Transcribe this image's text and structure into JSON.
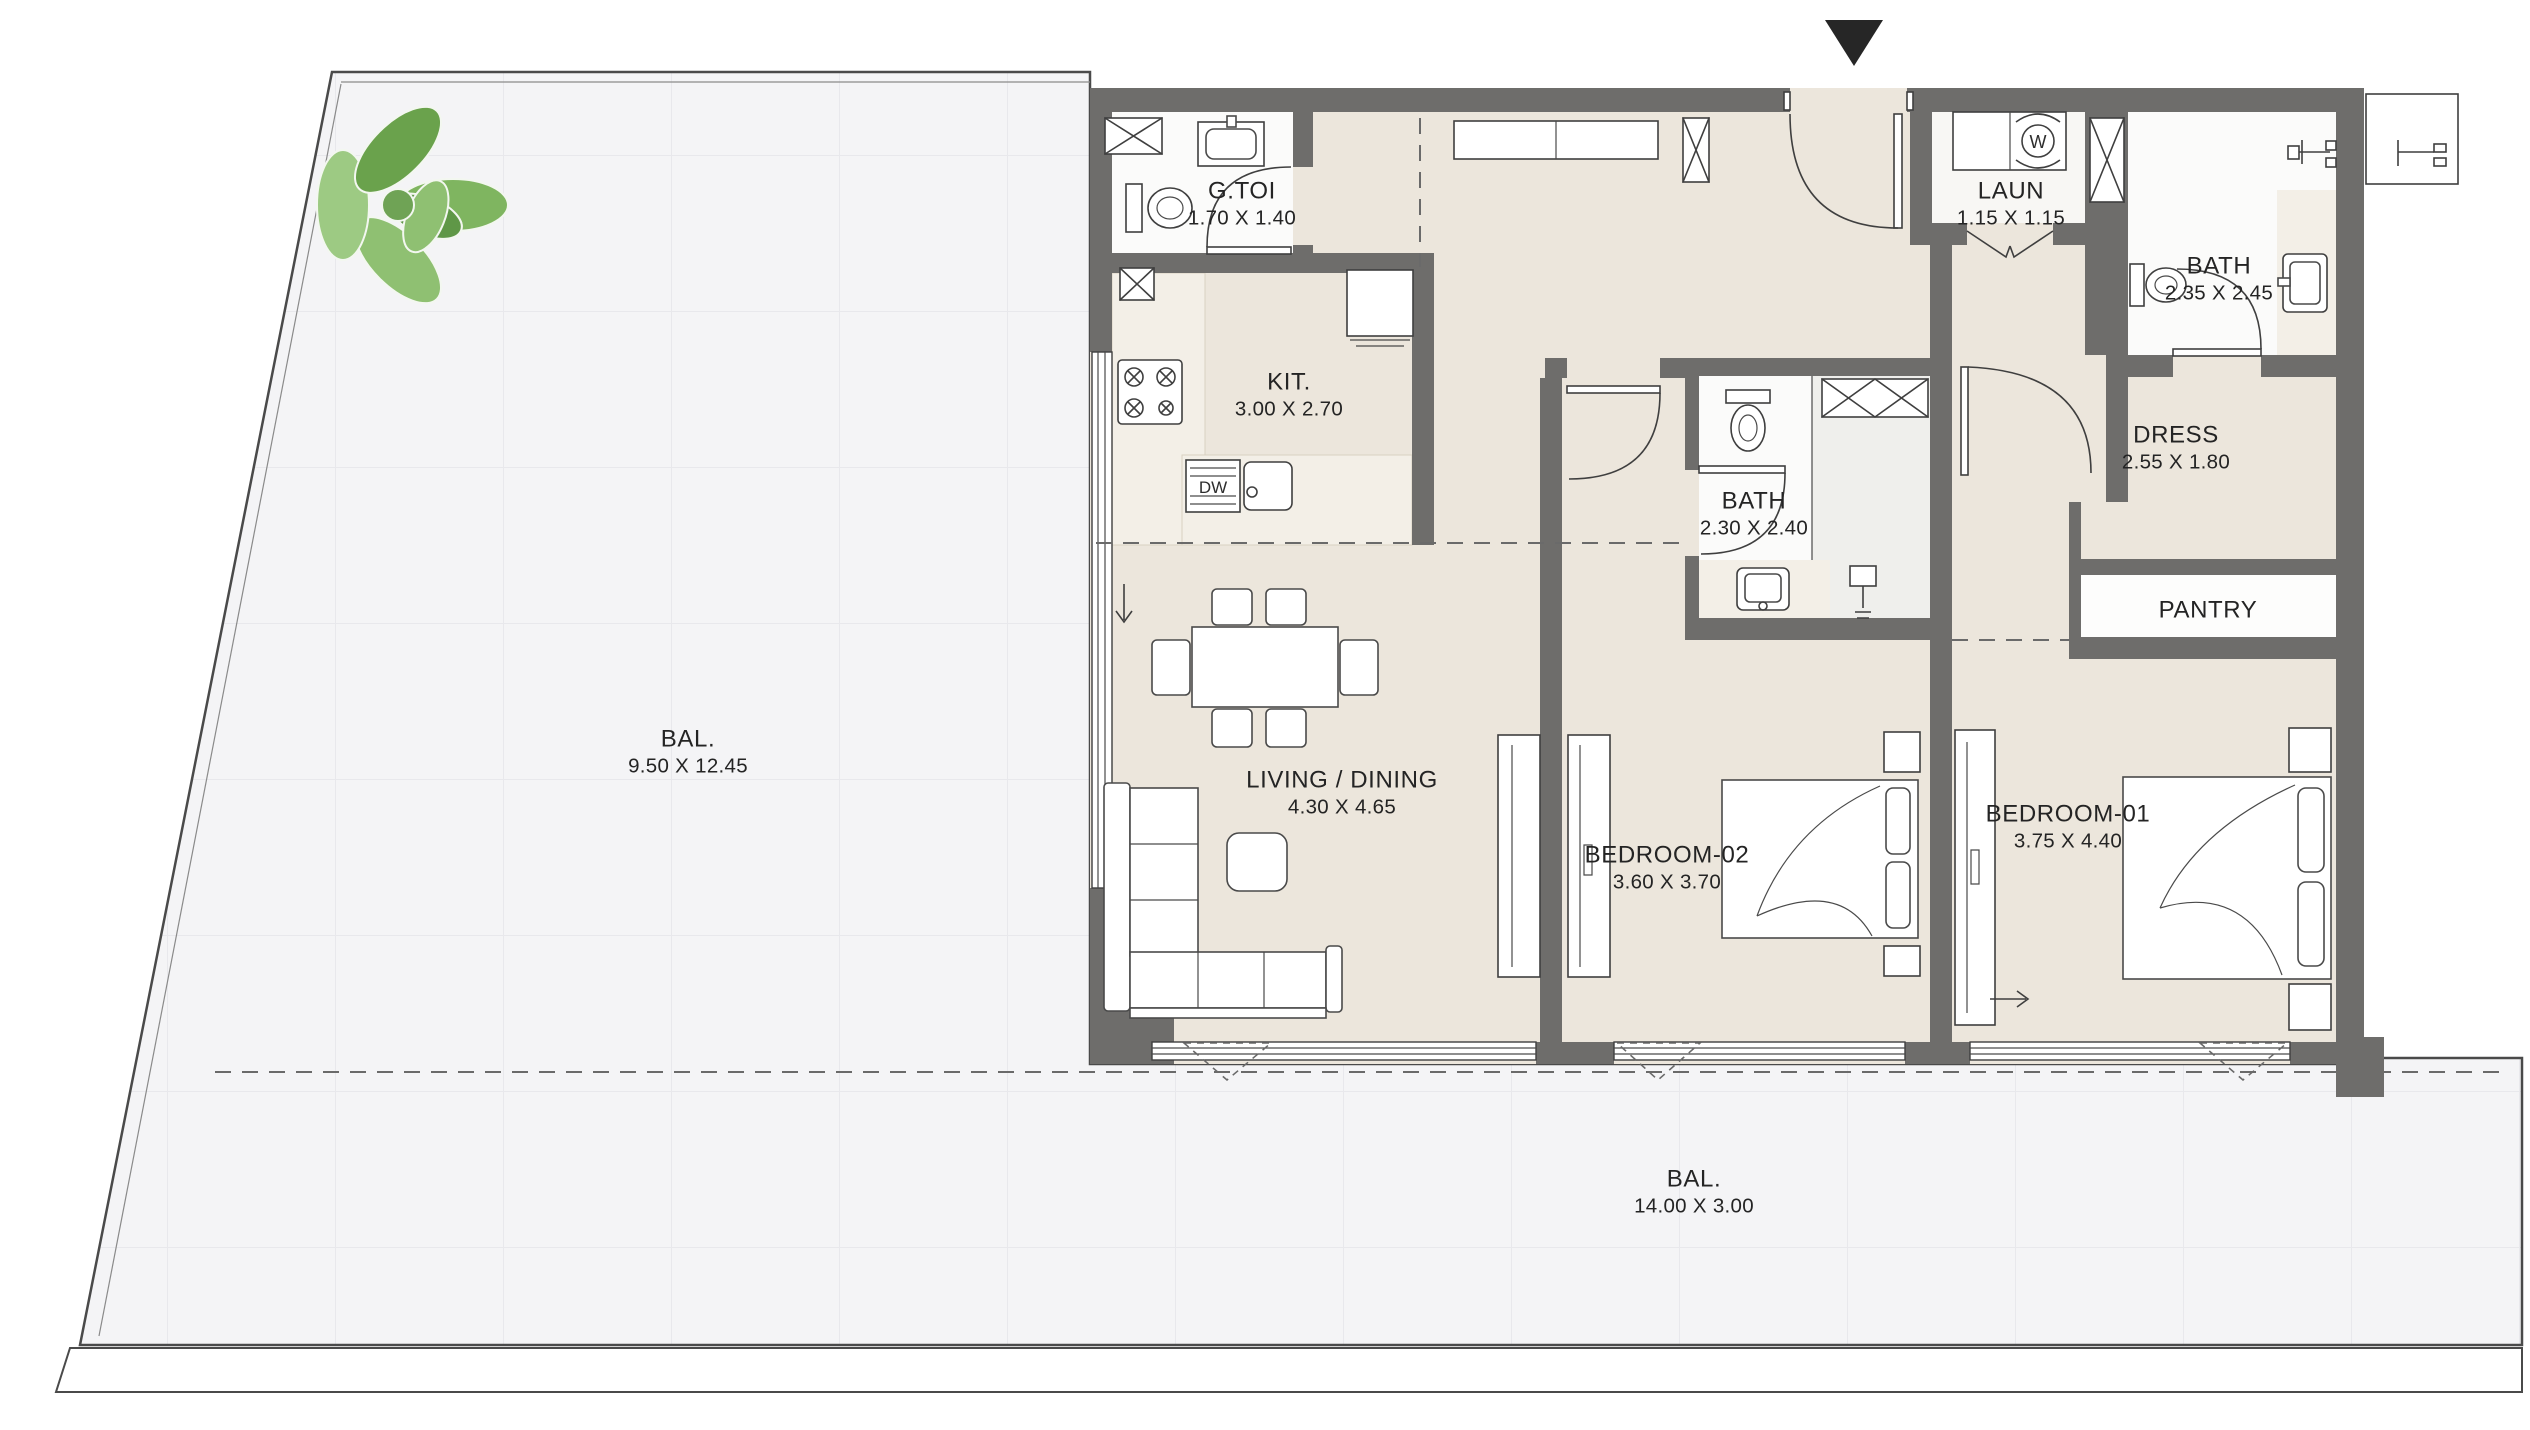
{
  "plan": {
    "type": "apartment-floor-plan",
    "rooms": {
      "bal_left": {
        "name": "BAL.",
        "dims": "9.50 X 12.45"
      },
      "bal_bottom": {
        "name": "BAL.",
        "dims": "14.00 X 3.00"
      },
      "g_toi": {
        "name": "G.TOI",
        "dims": "1.70 X 1.40"
      },
      "kit": {
        "name": "KIT.",
        "dims": "3.00 X 2.70"
      },
      "laun": {
        "name": "LAUN",
        "dims": "1.15 X 1.15"
      },
      "bath_1": {
        "name": "BATH",
        "dims": "2.35 X 2.45"
      },
      "bath_2": {
        "name": "BATH",
        "dims": "2.30 X 2.40"
      },
      "dress": {
        "name": "DRESS",
        "dims": "2.55 X 1.80"
      },
      "pantry": {
        "name": "PANTRY",
        "dims": ""
      },
      "living": {
        "name": "LIVING / DINING",
        "dims": "4.30 X 4.65"
      },
      "bedroom_2": {
        "name": "BEDROOM-02",
        "dims": "3.60 X 3.70"
      },
      "bedroom_1": {
        "name": "BEDROOM-01",
        "dims": "3.75 X 4.40"
      }
    },
    "labels": {
      "dishwasher": "DW",
      "washer_letter": "W"
    },
    "colors": {
      "wall": "#6e6d6b",
      "unit_floor": "#ece6dc",
      "balcony_floor": "#f4f4f6",
      "bath_floor": "#fbfbfa",
      "marble": "#f3efe7",
      "shower_floor": "#efefec",
      "line": "#3f3f3f",
      "label_text": "#242424",
      "entry_triangle": "#262626",
      "plant_green": "#85b968"
    }
  }
}
